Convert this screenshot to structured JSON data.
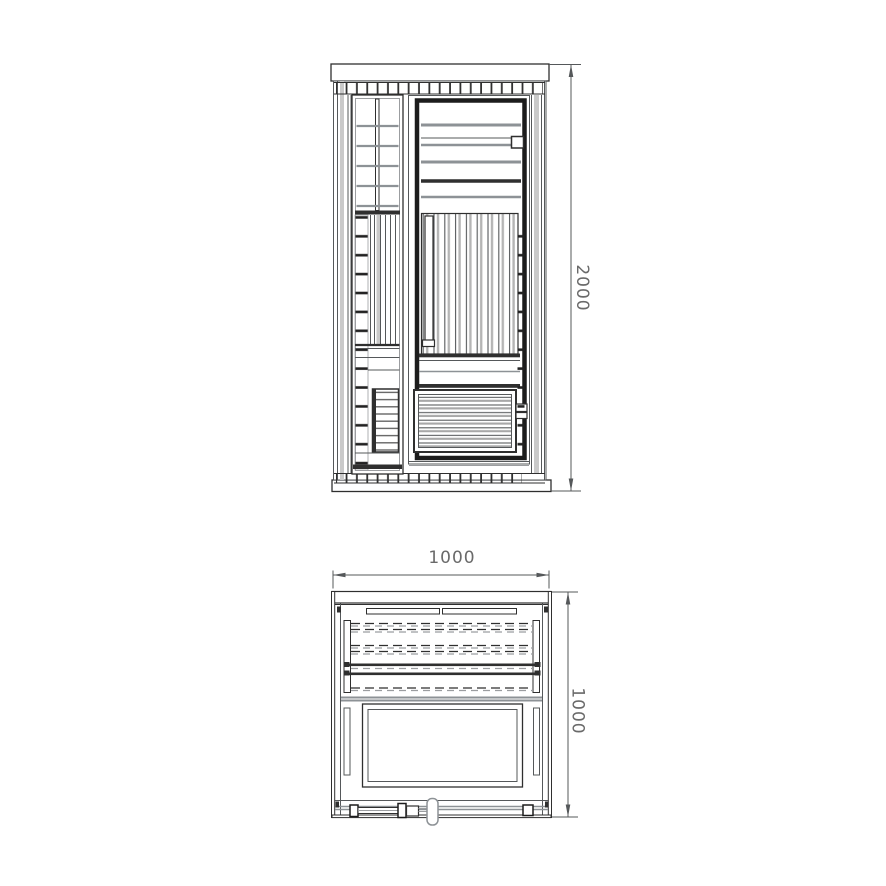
{
  "drawing": {
    "views": {
      "front": {
        "dimension_height": "2000"
      },
      "plan": {
        "dimension_width": "1000",
        "dimension_depth": "1000"
      }
    }
  },
  "colors": {
    "background": "#ffffff",
    "line-black": "#1c1c1c",
    "line-dark": "#2f2f2f",
    "line-medium": "#55585a",
    "line-gray": "#8d9296",
    "line-light": "#9b9da0",
    "shade": "#c9c9c9",
    "dimension-text": "#6a6a6a"
  }
}
